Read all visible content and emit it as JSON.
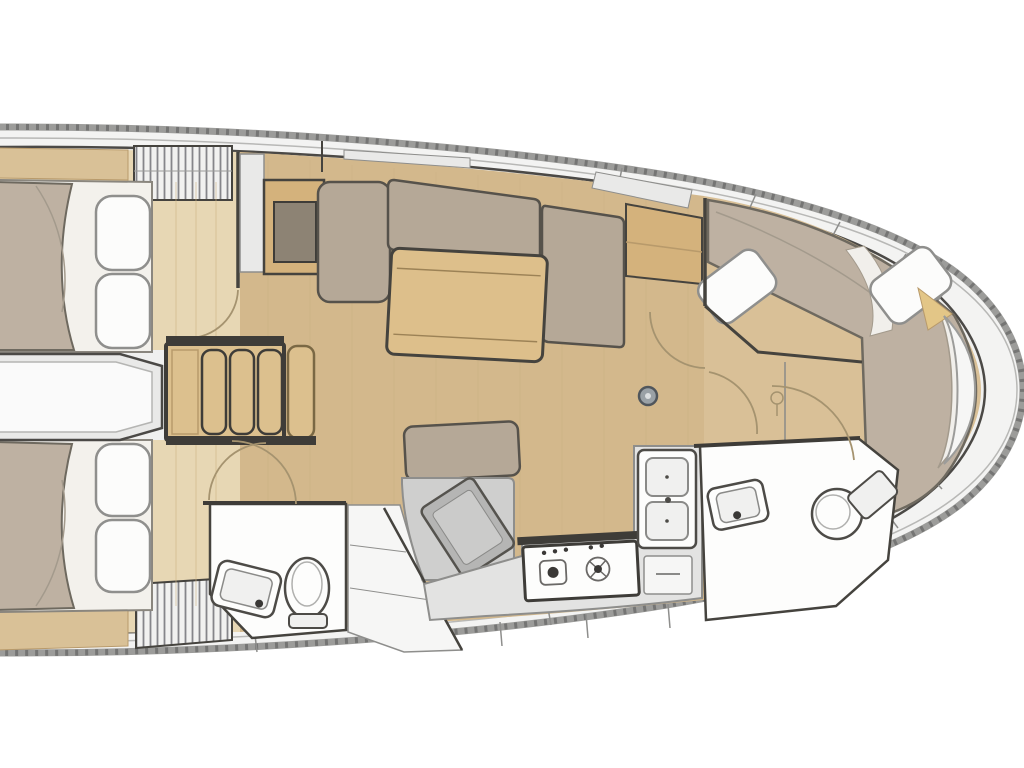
{
  "vessel": {
    "type": "sailing-yacht-interior-floor-plan",
    "orientation": "bow-right",
    "rooms": [
      {
        "name": "aft-cabin-top",
        "fixtures": [
          "double-berth",
          "pillows",
          "louvered-locker"
        ]
      },
      {
        "name": "aft-cabin-bottom",
        "fixtures": [
          "double-berth",
          "pillows",
          "louvered-locker"
        ]
      },
      {
        "name": "aft-head",
        "fixtures": [
          "toilet",
          "washbasin"
        ]
      },
      {
        "name": "engine-passage",
        "fixtures": []
      },
      {
        "name": "companionway",
        "fixtures": [
          "steps"
        ]
      },
      {
        "name": "saloon",
        "fixtures": [
          "settee",
          "dining-table",
          "bench-seat",
          "tv-cabinet",
          "mast-step"
        ]
      },
      {
        "name": "nav-station",
        "fixtures": [
          "chart-table"
        ]
      },
      {
        "name": "galley",
        "fixtures": [
          "stove",
          "double-sink",
          "counter",
          "drawers"
        ]
      },
      {
        "name": "forward-head",
        "fixtures": [
          "toilet",
          "washbasin"
        ]
      },
      {
        "name": "forward-cabin",
        "fixtures": [
          "island-berth",
          "pillows",
          "bow-locker"
        ]
      }
    ]
  },
  "palette": {
    "page_bg": "#ffffff",
    "hull_band": "#9c9c9a",
    "hull_dash": "#6f6f6d",
    "hull_inner_line": "#b8b8b6",
    "deck_margin": "#f3f3f2",
    "inner_deck": "#f0f0ef",
    "interior_stroke": "#4b4946",
    "wall_dark": "#45433e",
    "bar_dark": "#3e3c38",
    "floor_salon": "#d3b88c",
    "floor_cabin": "#e7d7b4",
    "floor_fwd": "#d9c097",
    "wood_shelf": "#d9c197",
    "wood_table": "#ddbf8b",
    "wood_groove": "#9c8256",
    "wood_step": "#dcc08e",
    "wood_step_edge": "#7a6844",
    "wood_cabinet": "#d4b27c",
    "wood_edge": "#b89a6b",
    "cabinet_inset": "#8d8374",
    "cushion": "#b5a897",
    "cushion_stroke": "#56524b",
    "blanket": "#beb1a2",
    "blanket_stroke": "#6e695f",
    "mattress": "#f3f1ec",
    "mattress_stroke": "#8a867e",
    "pillow": "#fcfcfb",
    "pillow_stroke": "#8f8f8d",
    "sheet_white": "#f1efeb",
    "sheet_line": "#a39a8c",
    "fixture_white": "#fdfdfc",
    "fixture_stroke": "#4d4b47",
    "fixture_inner": "#f0f0ef",
    "fixture_inner_stroke": "#8a8a88",
    "counter_gray": "#e3e3e2",
    "counter_stroke": "#8e8e8c",
    "nav_gray": "#cfcfce",
    "nav_desk": "#b5b5b4",
    "nav_desk_inner": "#cbcbca",
    "nav_desk_stroke": "#55534e",
    "locker_gray": "#e9e9e8",
    "locker_white": "#f6f6f5",
    "hatch_line": "#85858a",
    "hatch_bg": "#f1f1f0",
    "arc_line": "#a5936f",
    "mast_ring": "#50565c",
    "mast_fill": "#9aa1a6",
    "mast_dot": "#dcdfe1",
    "burner_ring": "#6b6967",
    "burner_dark": "#3a3836",
    "window_slat": "#e9e9e8",
    "plank_line": "#cdb183",
    "grain_line": "#c3a678",
    "wood_wedge": "#e3c687",
    "passage_white": "#fafafa",
    "passage_line": "#b5b5b3",
    "toilet_inner": "#b0b0ae"
  }
}
